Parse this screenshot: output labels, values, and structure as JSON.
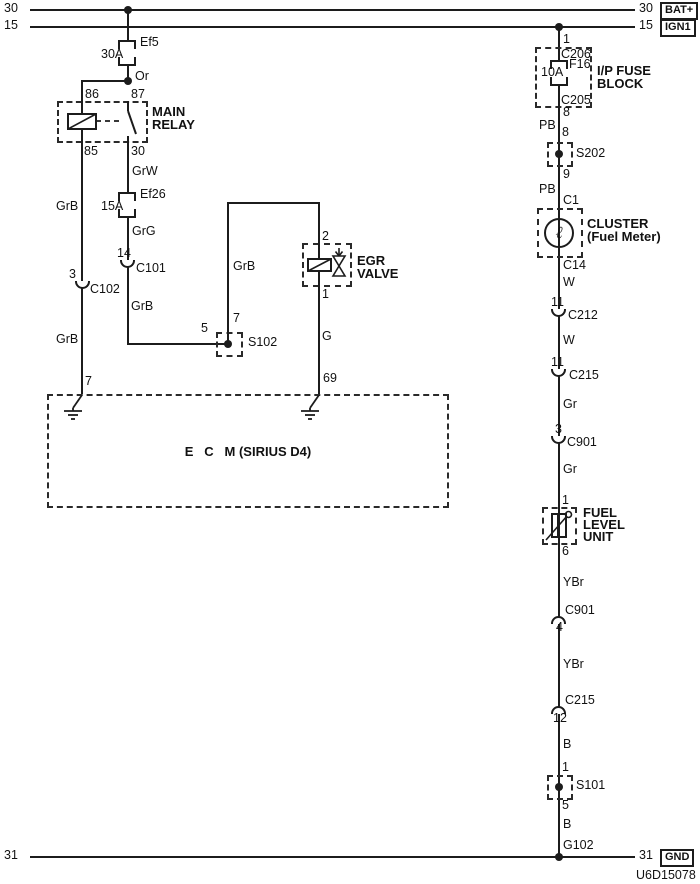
{
  "meta": {
    "doc_id": "U6D15078"
  },
  "buses": {
    "b30": {
      "left": "30",
      "right": "30",
      "tag": "BAT+"
    },
    "b15": {
      "left": "15",
      "right": "15",
      "tag": "IGN1"
    },
    "b31": {
      "left": "31",
      "right": "31",
      "tag": "GND"
    }
  },
  "relay_branch": {
    "fuse_ef5_id": "Ef5",
    "fuse_ef5_rating": "30A",
    "wire_or": "Or",
    "pin_86": "86",
    "pin_87": "87",
    "relay_name_1": "MAIN",
    "relay_name_2": "RELAY",
    "pin_85": "85",
    "pin_30": "30",
    "wire_grb_left_1": "GrB",
    "conn_c102_pin": "3",
    "conn_c102_id": "C102",
    "wire_grb_left_2": "GrB",
    "ecm_pin_7": "7",
    "wire_grw": "GrW",
    "fuse_ef26_id": "Ef26",
    "fuse_ef26_rating": "15A",
    "wire_grg": "GrG",
    "conn_c101_pin": "14",
    "conn_c101_id": "C101",
    "wire_grb_mid": "GrB",
    "s102_pin_5": "5",
    "s102_pin_7": "7",
    "s102_id": "S102"
  },
  "egr_branch": {
    "wire_grb": "GrB",
    "pin_2": "2",
    "valve_name_1": "EGR",
    "valve_name_2": "VALVE",
    "pin_1": "1",
    "wire_g": "G",
    "ecm_pin_69": "69"
  },
  "ecm": {
    "label": "E   C   M (SIRIUS D4)"
  },
  "fuel_branch": {
    "pin_1": "1",
    "conn_c206": "C206",
    "fuse_f16_id": "F16",
    "fuse_f16_rating": "10A",
    "conn_c205": "C205",
    "fuse_block_name_1": "I/P FUSE",
    "fuse_block_name_2": "BLOCK",
    "pin_8_top": "8",
    "wire_pb_1": "PB",
    "pin_8_bottom": "8",
    "s202_id": "S202",
    "pin_9": "9",
    "wire_pb_2": "PB",
    "conn_c1": "C1",
    "cluster_name_1": "CLUSTER",
    "cluster_name_2": "(Fuel Meter)",
    "gauge_glyph": "ℓ",
    "conn_c14": "C14",
    "wire_w_1": "W",
    "conn_c212_pin": "11",
    "conn_c212_id": "C212",
    "wire_w_2": "W",
    "conn_c215_pin": "11",
    "conn_c215_id": "C215",
    "wire_gr_1": "Gr",
    "conn_c901_pin": "3",
    "conn_c901_id": "C901",
    "wire_gr_2": "Gr",
    "flu_pin_1": "1",
    "flu_name_1": "FUEL",
    "flu_name_2": "LEVEL",
    "flu_name_3": "UNIT",
    "flu_pin_6": "6",
    "wire_ybr_1": "YBr",
    "conn_c901b_id": "C901",
    "conn_c901b_pin": "4",
    "wire_ybr_2": "YBr",
    "conn_c215b_id": "C215",
    "conn_c215b_pin": "12",
    "wire_b_1": "B",
    "s101_pin_1": "1",
    "s101_id": "S101",
    "s101_pin_5": "5",
    "wire_b_2": "B",
    "ground_id": "G102"
  }
}
